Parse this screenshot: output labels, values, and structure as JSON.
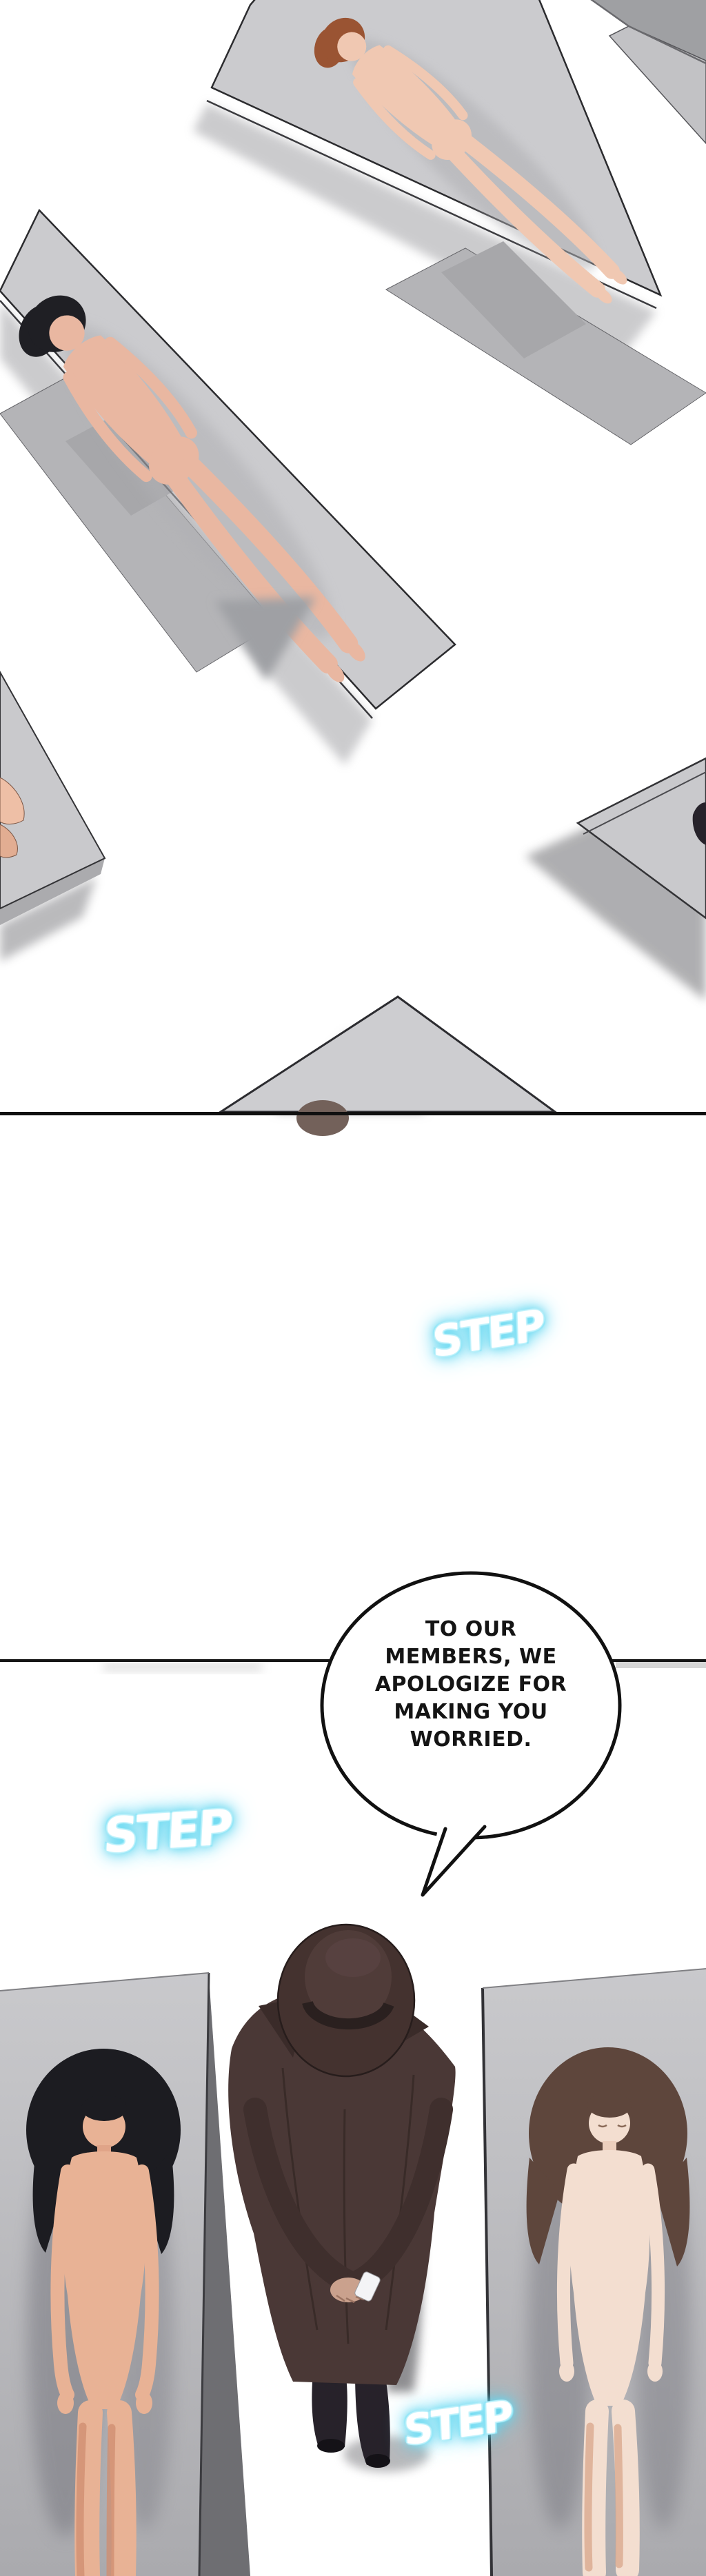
{
  "document": {
    "type": "webtoon-comic-page",
    "language": "en",
    "background": "#ffffff"
  },
  "speech_bubble": {
    "shape": "ellipse",
    "tail_direction": "down-left",
    "full_text": "TO OUR MEMBERS, WE APOLOGIZE FOR MAKING YOU WORRIED.",
    "lines": [
      "TO OUR",
      "MEMBERS, WE",
      "APOLOGIZE FOR",
      "MAKING YOU",
      "WORRIED."
    ]
  },
  "sfx": {
    "items": [
      "STEP",
      "STEP",
      "STEP"
    ],
    "text_color": "#ffffff",
    "glow_color": "#54d2ef"
  },
  "palette": {
    "background": "#ffffff",
    "panel_border": "#101010",
    "table_top": "#cbcbce",
    "table_side": "#b4b4b7",
    "shadow_grey": "#9fa0a4",
    "slab_grey": "#bcbcbf",
    "slab_dark_band": "#6e6e72",
    "coat_brown": "#4a3836",
    "hat_brown": "#44322f",
    "boot_black": "#27222a",
    "skin_light": "#f0c8b2",
    "skin_warm": "#e8b295",
    "skin_pale": "#f3ded0",
    "hair_black": "#1c1c21",
    "hair_auburn": "#9a5433",
    "hair_brown": "#5e463c"
  },
  "scene": {
    "panels": [
      {
        "name": "overhead-room-with-tables",
        "figures": [
          "lying-figure-auburn-hair",
          "lying-figure-black-hair"
        ]
      },
      {
        "name": "white-transition-gap"
      },
      {
        "name": "overhead-room-three-figures",
        "figures": [
          "lying-figure-black-hair",
          "standing-figure-coat-and-fedora",
          "lying-figure-brown-hair"
        ]
      }
    ]
  }
}
